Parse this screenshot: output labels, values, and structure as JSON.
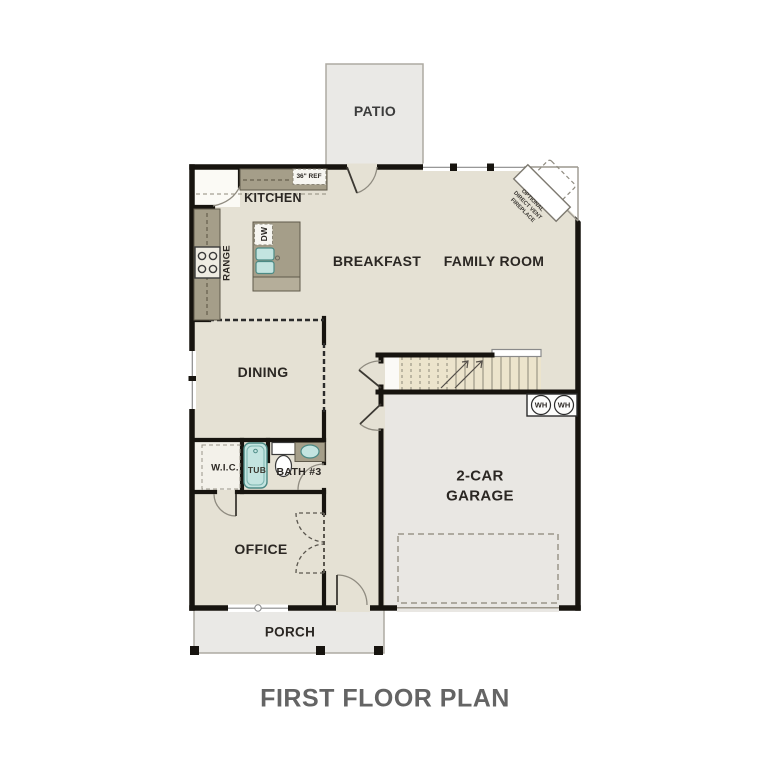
{
  "title": "FIRST FLOOR PLAN",
  "plan_name": "First Floor Plan",
  "colors": {
    "floor": "#e5e1d4",
    "garage_floor": "#e9e7e3",
    "outdoor": "#eae9e6",
    "wall": "#17140f",
    "counter": "#a59e89",
    "counter_border": "#5f594a",
    "fixture_teal": "#c3e4e0",
    "fixture_teal_border": "#4c8a85",
    "stairs": "#ece4cc",
    "title_gray": "#646464"
  },
  "labels": {
    "patio": "PATIO",
    "kitchen": "KITCHEN",
    "ref": "36\" REF",
    "range": "RANGE",
    "dw": "DW",
    "breakfast": "BREAKFAST",
    "family_room": "FAMILY ROOM",
    "fireplace": "OPTIONAL\nDIRECT VENT\nFIREPLACE",
    "dining": "DINING",
    "wic": "W.I.C.",
    "tub": "TUB",
    "bath3": "BATH #3",
    "garage": "2-CAR GARAGE",
    "wh1": "WH",
    "wh2": "WH",
    "office": "OFFICE",
    "porch": "PORCH"
  }
}
